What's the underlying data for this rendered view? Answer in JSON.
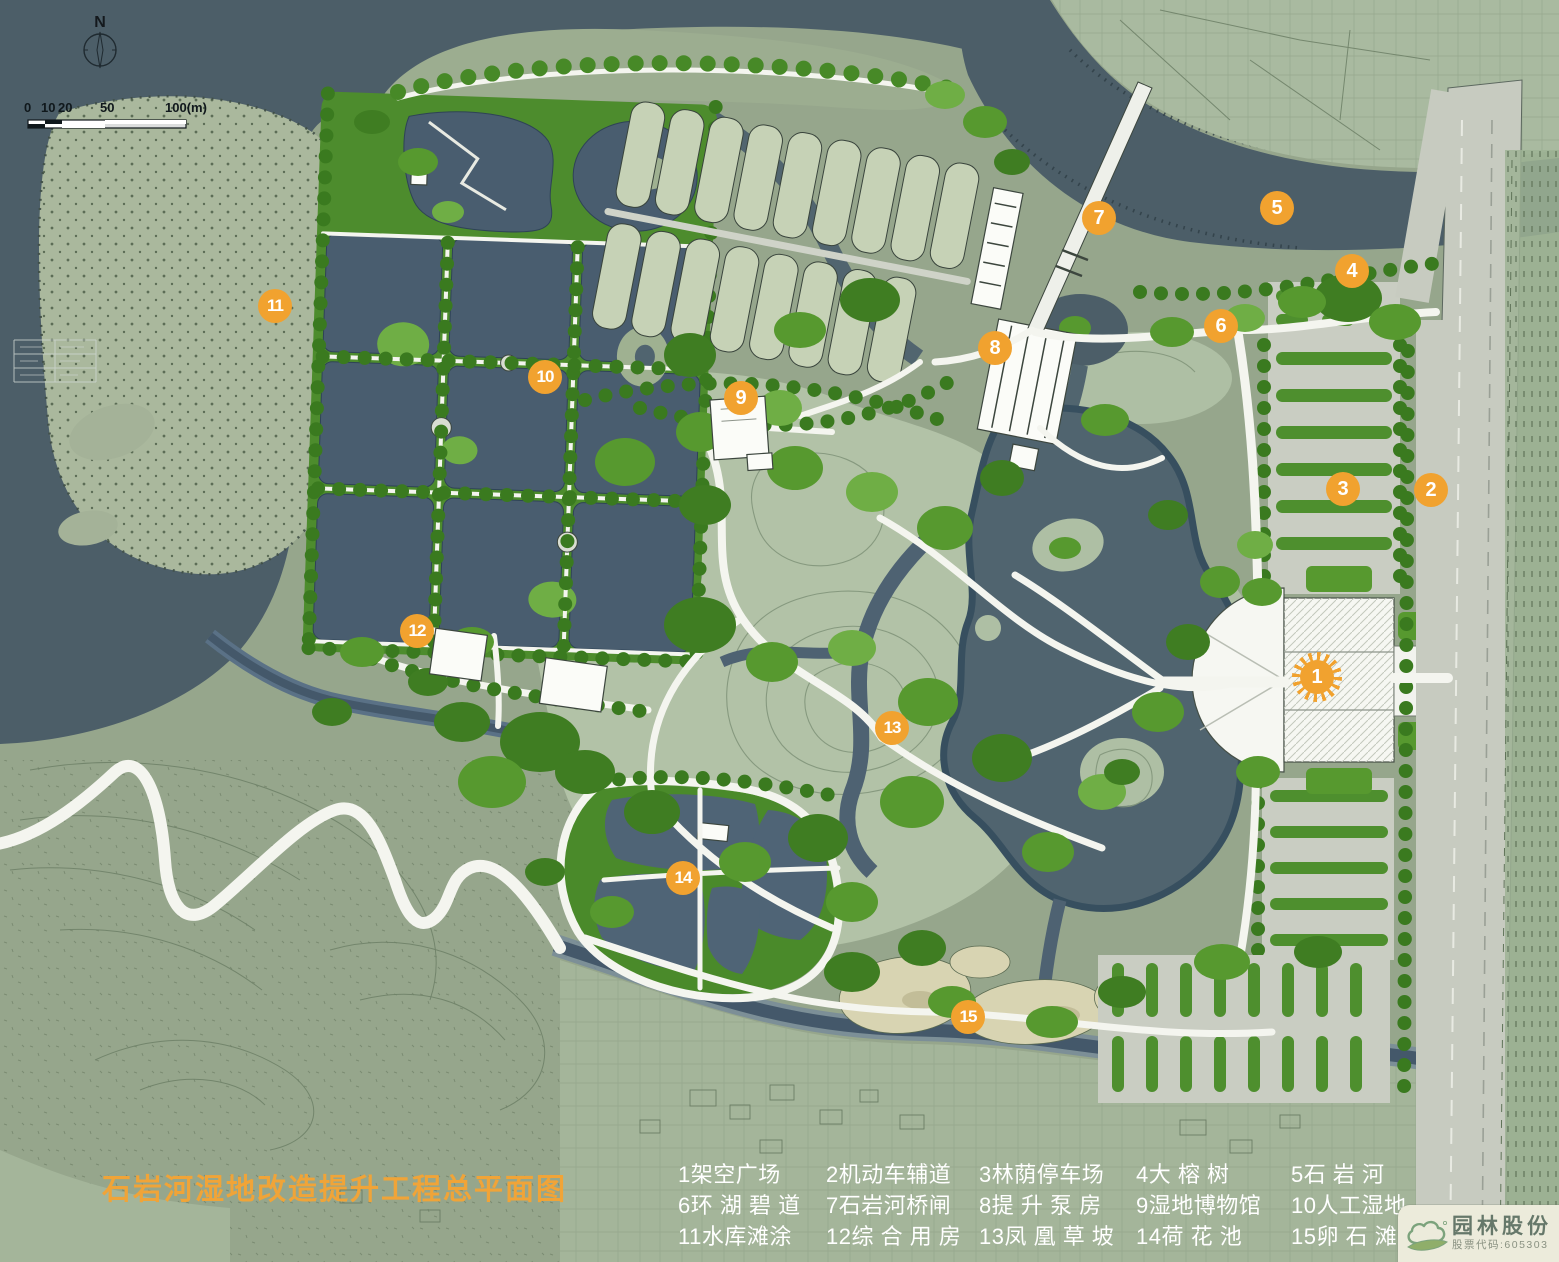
{
  "title": "石岩河湿地改造提升工程总平面图",
  "legend": {
    "items": [
      {
        "num": "1",
        "label": "架空广场"
      },
      {
        "num": "2",
        "label": "机动车辅道"
      },
      {
        "num": "3",
        "label": "林荫停车场"
      },
      {
        "num": "4",
        "label": "大 榕 树"
      },
      {
        "num": "5",
        "label": "石 岩 河"
      },
      {
        "num": "6",
        "label": "环 湖 碧 道"
      },
      {
        "num": "7",
        "label": "石岩河桥闸"
      },
      {
        "num": "8",
        "label": "提 升 泵 房"
      },
      {
        "num": "9",
        "label": "湿地博物馆"
      },
      {
        "num": "10",
        "label": "人工湿地"
      },
      {
        "num": "11",
        "label": "水库滩涂"
      },
      {
        "num": "12",
        "label": "综 合 用 房"
      },
      {
        "num": "13",
        "label": "凤 凰 草 坡"
      },
      {
        "num": "14",
        "label": "荷 花 池"
      },
      {
        "num": "15",
        "label": "卵 石 滩"
      }
    ]
  },
  "map": {
    "markers": [
      {
        "num": "1",
        "x": 1317,
        "y": 677,
        "burst": true
      },
      {
        "num": "2",
        "x": 1431,
        "y": 490
      },
      {
        "num": "3",
        "x": 1343,
        "y": 489
      },
      {
        "num": "4",
        "x": 1352,
        "y": 271
      },
      {
        "num": "5",
        "x": 1277,
        "y": 208
      },
      {
        "num": "6",
        "x": 1221,
        "y": 326
      },
      {
        "num": "7",
        "x": 1099,
        "y": 218
      },
      {
        "num": "8",
        "x": 995,
        "y": 348
      },
      {
        "num": "9",
        "x": 741,
        "y": 398
      },
      {
        "num": "10",
        "x": 545,
        "y": 377
      },
      {
        "num": "11",
        "x": 275,
        "y": 306
      },
      {
        "num": "12",
        "x": 417,
        "y": 631
      },
      {
        "num": "13",
        "x": 892,
        "y": 728
      },
      {
        "num": "14",
        "x": 683,
        "y": 878
      },
      {
        "num": "15",
        "x": 968,
        "y": 1017
      }
    ],
    "compass": {
      "label": "N"
    },
    "scalebar": {
      "labels": [
        "0",
        "10",
        "20",
        "50",
        "100(m)"
      ]
    }
  },
  "logo": {
    "company": "园林股份",
    "stock_code": "股票代码:605303"
  },
  "palette": {
    "marker_orange": "#f1a22f",
    "title_orange": "#f0a438",
    "water_dark": "#4c5e68",
    "pond_blue": "#495d6f",
    "tree_green": "#57992f",
    "dike_green": "#4a8a2a",
    "meadow_green": "#b2c2a7",
    "land_green": "#96a68c",
    "mudflat_green": "#aab89d",
    "road_white": "#f4f5ef",
    "road_gray": "#c9cdc2",
    "beach_tan": "#d8d4b2",
    "legend_text": "#ffffff"
  }
}
